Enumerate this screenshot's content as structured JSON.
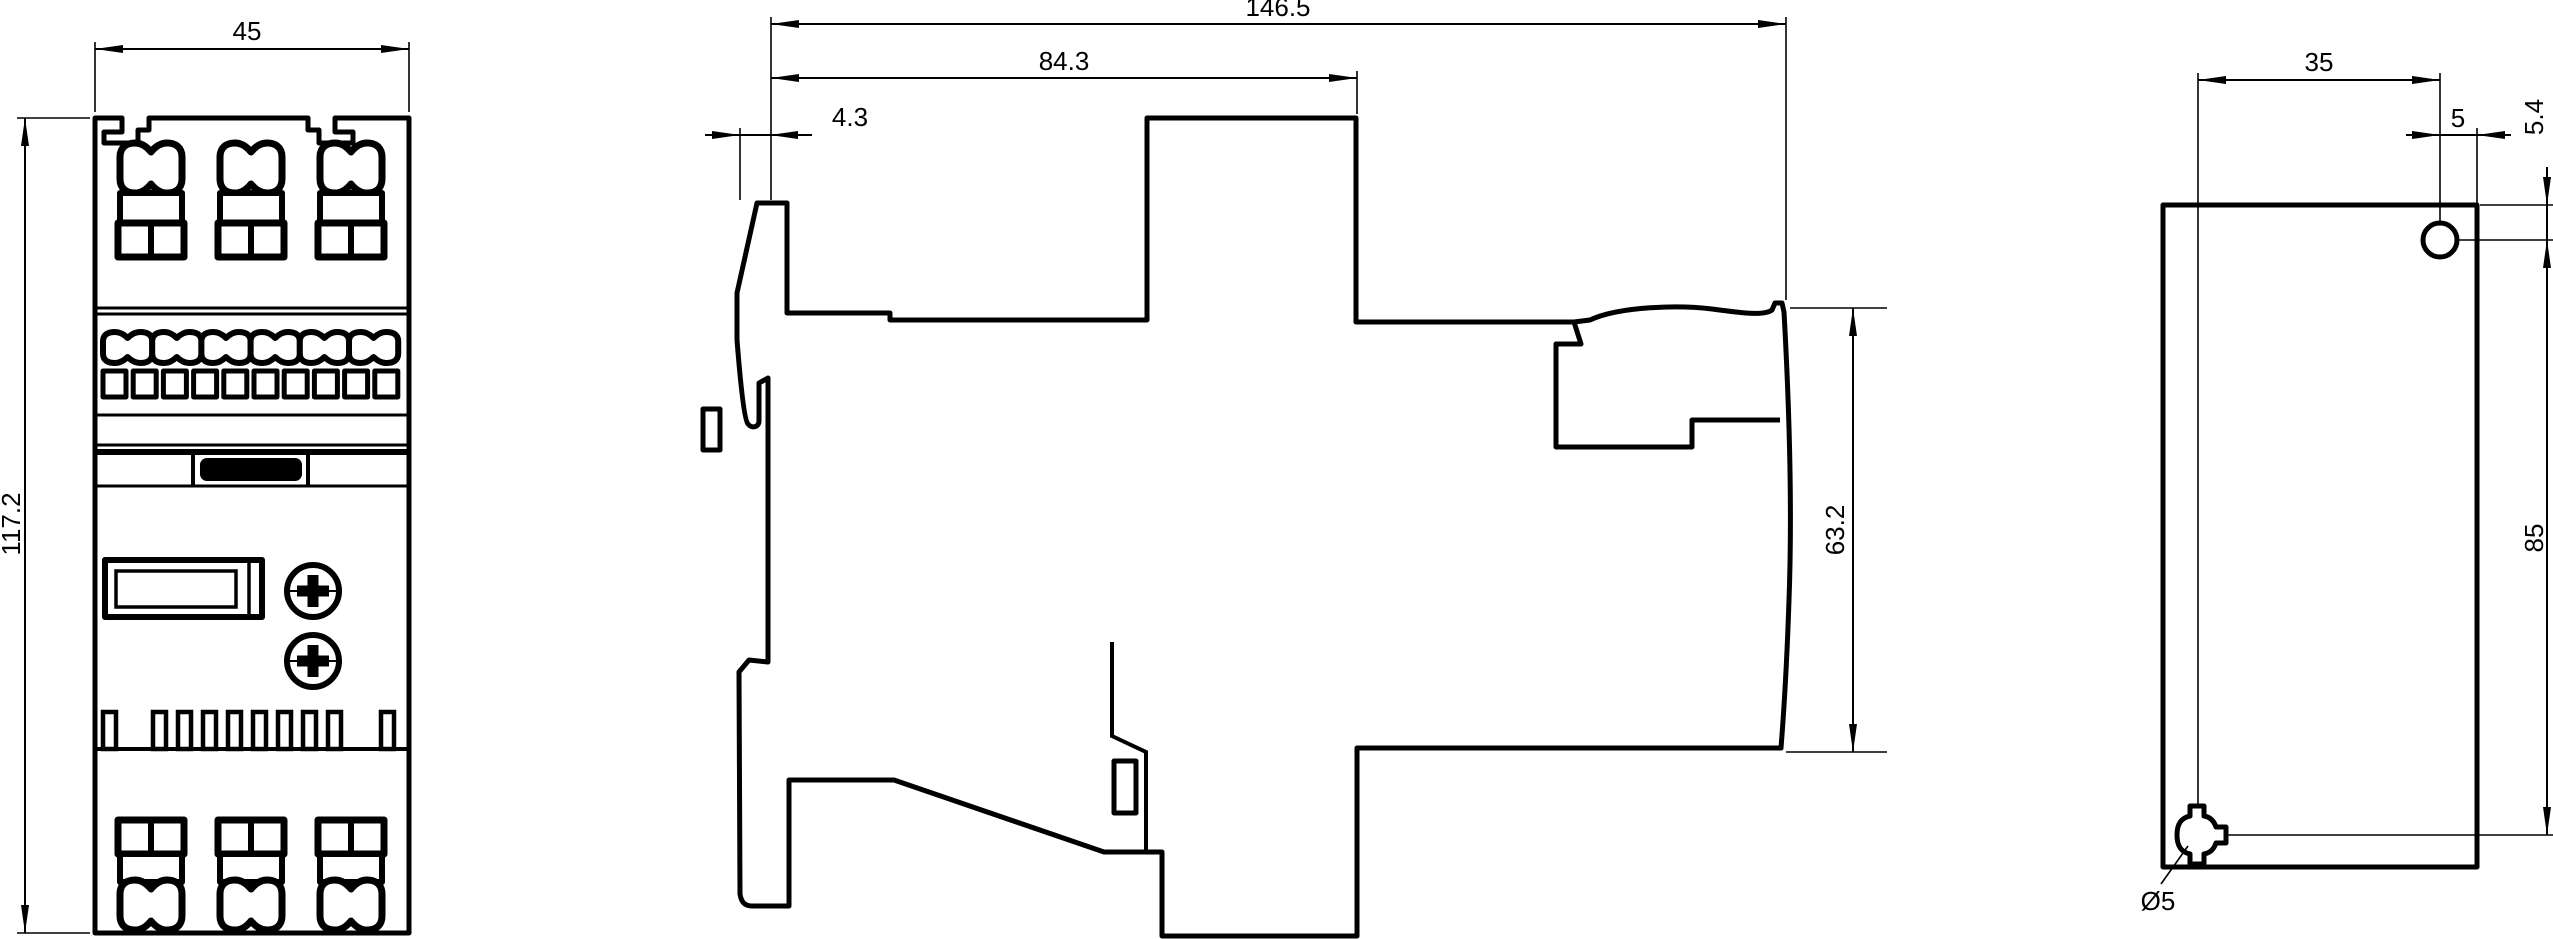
{
  "drawing": {
    "background_color": "#ffffff",
    "line_color": "#000000",
    "dimensions": {
      "front_width": "45",
      "front_height": "117.2",
      "side_total_depth": "146.5",
      "side_body_depth": "84.3",
      "side_front_tab": "4.3",
      "side_rail_height": "63.2",
      "rear_hole_spacing_x": "35",
      "rear_hole_edge_offset": "5",
      "rear_hole_top_offset": "5.4",
      "rear_hole_spacing_y": "85",
      "rear_hole_diameter": "Ø5"
    }
  }
}
